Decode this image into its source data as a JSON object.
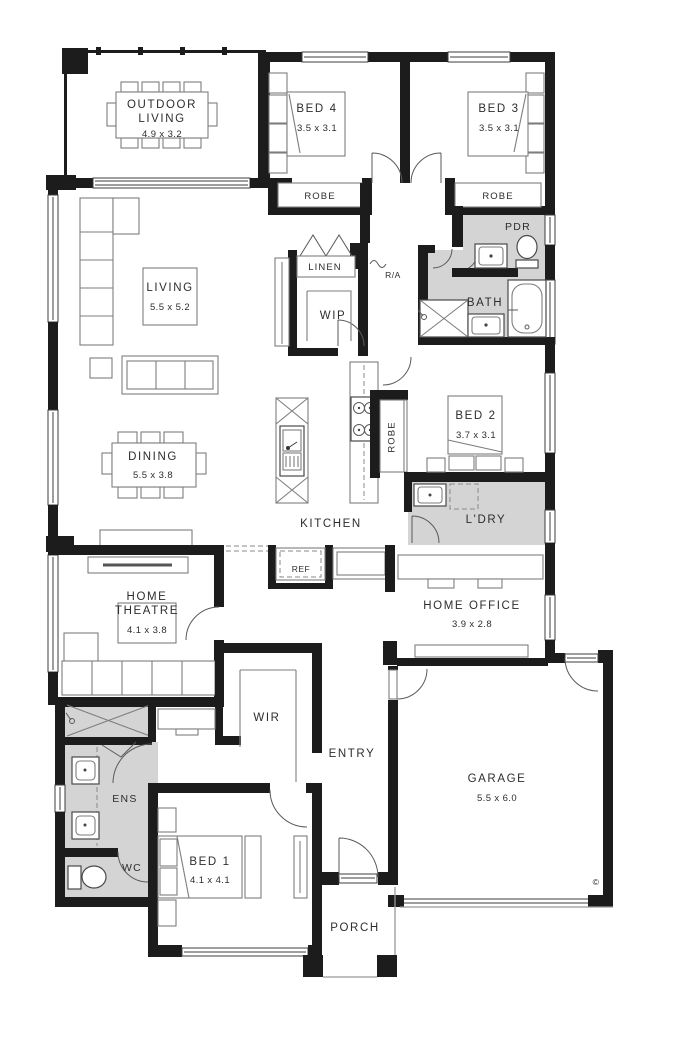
{
  "plan": {
    "type": "residential-floor-plan",
    "colors": {
      "wall": "#1c1c1c",
      "wet_area": "#d4d4d4",
      "line": "#777777"
    },
    "rooms": {
      "outdoor_living": {
        "label": "OUTDOOR LIVING",
        "dims": "4.9 x 3.2"
      },
      "bed4": {
        "label": "BED 4",
        "dims": "3.5 x 3.1"
      },
      "bed3": {
        "label": "BED 3",
        "dims": "3.5 x 3.1"
      },
      "robe_bed4": {
        "label": "ROBE"
      },
      "robe_bed3": {
        "label": "ROBE"
      },
      "linen": {
        "label": "LINEN"
      },
      "return_air": {
        "label": "R/A"
      },
      "powder": {
        "label": "PDR"
      },
      "bath": {
        "label": "BATH"
      },
      "living": {
        "label": "LIVING",
        "dims": "5.5 x 5.2"
      },
      "wip": {
        "label": "WIP"
      },
      "bed2": {
        "label": "BED 2",
        "dims": "3.7 x 3.1"
      },
      "robe_bed2": {
        "label": "ROBE"
      },
      "dining": {
        "label": "DINING",
        "dims": "5.5 x 3.8"
      },
      "kitchen": {
        "label": "KITCHEN"
      },
      "laundry": {
        "label": "L'DRY"
      },
      "fridge": {
        "label": "REF"
      },
      "home_theatre": {
        "label": "HOME THEATRE",
        "dims": "4.1 x 3.8"
      },
      "home_office": {
        "label": "HOME OFFICE",
        "dims": "3.9 x 2.8"
      },
      "wir": {
        "label": "WIR"
      },
      "entry": {
        "label": "ENTRY"
      },
      "garage": {
        "label": "GARAGE",
        "dims": "5.5 x 6.0"
      },
      "ensuite": {
        "label": "ENS"
      },
      "wc": {
        "label": "WC"
      },
      "bed1": {
        "label": "BED 1",
        "dims": "4.1 x 4.1"
      },
      "porch": {
        "label": "PORCH"
      },
      "copyright": {
        "label": "©"
      }
    }
  }
}
